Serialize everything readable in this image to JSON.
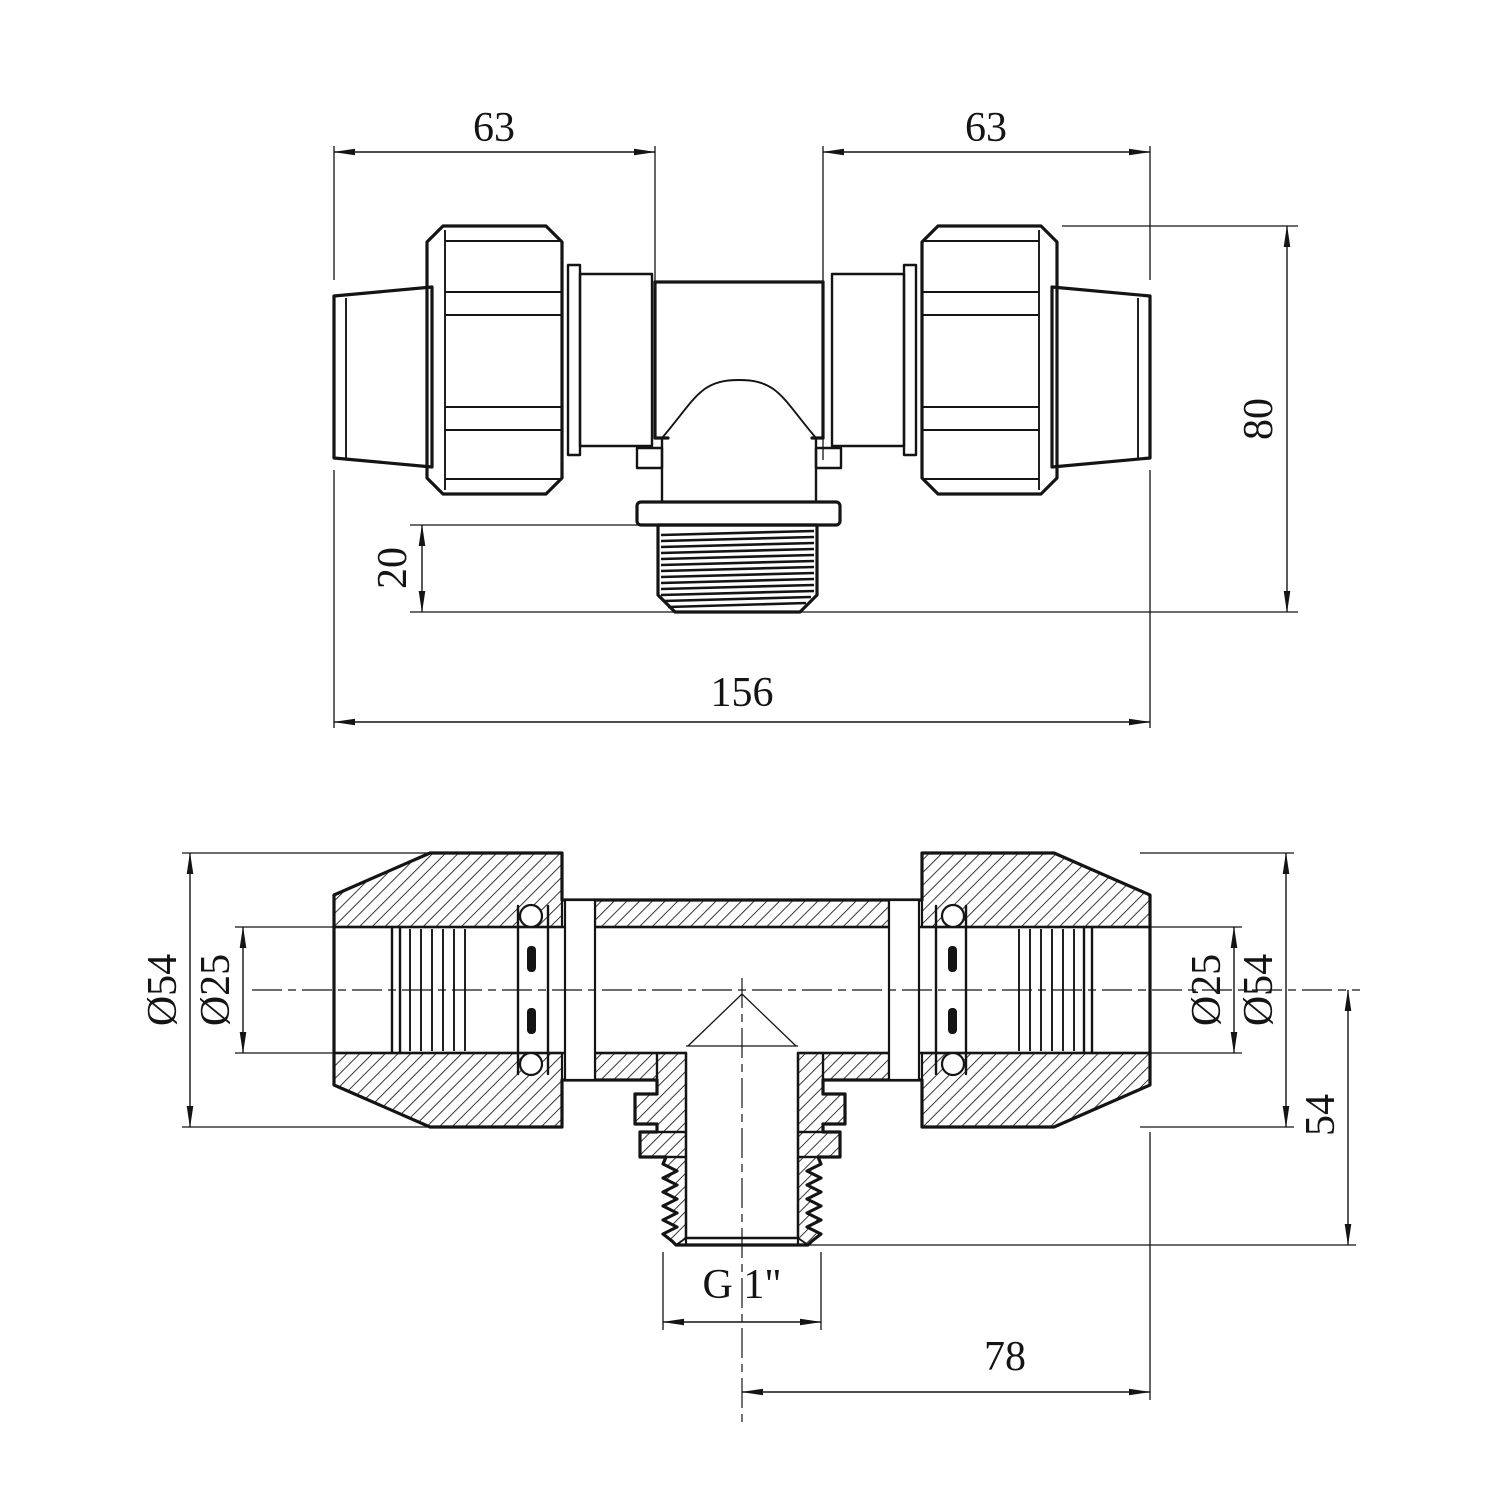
{
  "page": {
    "background": "#ffffff",
    "ink": "#141414",
    "kind": "technical drawing, compression tee fitting, two orthographic views"
  },
  "top_view": {
    "name": "external front view",
    "dims": {
      "left63": {
        "label": "63"
      },
      "right63": {
        "label": "63"
      },
      "height80": {
        "label": "80"
      },
      "thread20": {
        "label": "20"
      },
      "total156": {
        "label": "156"
      }
    }
  },
  "section_view": {
    "name": "cross-section view",
    "dims": {
      "d54_left": {
        "label": "Ø54"
      },
      "d25_left": {
        "label": "Ø25"
      },
      "d25_right": {
        "label": "Ø25"
      },
      "d54_right": {
        "label": "Ø54"
      },
      "depth54": {
        "label": "54"
      },
      "thread_g1": {
        "label": "G 1\""
      },
      "offset78": {
        "label": "78"
      }
    }
  }
}
